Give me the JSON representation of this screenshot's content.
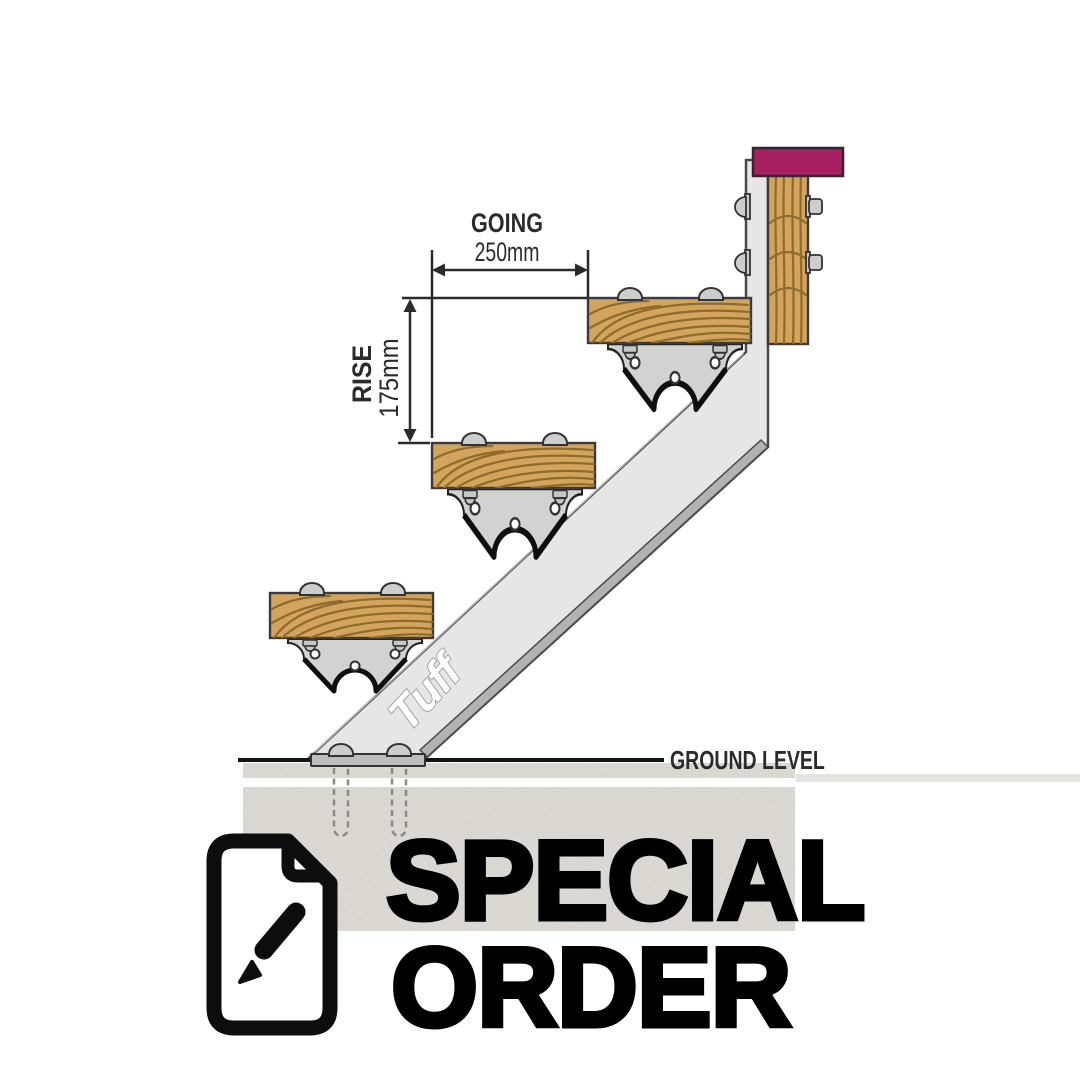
{
  "diagram": {
    "stringer_brand": "Tuff",
    "ground_label": "GROUND LEVEL",
    "going": {
      "label": "GOING",
      "value": "250mm"
    },
    "rise": {
      "label": "RISE",
      "value": "175mm"
    },
    "steps_visible": 3,
    "colors": {
      "post_cap": "#a62062",
      "wood": "#d3a45b",
      "wood_grain": "#8e6b2e",
      "steel": "#e6e6e6",
      "steel_edge": "#b2b2b2",
      "bracket": "#d2d2d2",
      "plate": "#bdbdbd",
      "concrete": "#e0ddd9",
      "outline": "#2b2b2b"
    }
  },
  "overlay": {
    "icon": "document-edit-icon",
    "line1": "SPECIAL",
    "line2": "ORDER",
    "color": "#000000"
  }
}
